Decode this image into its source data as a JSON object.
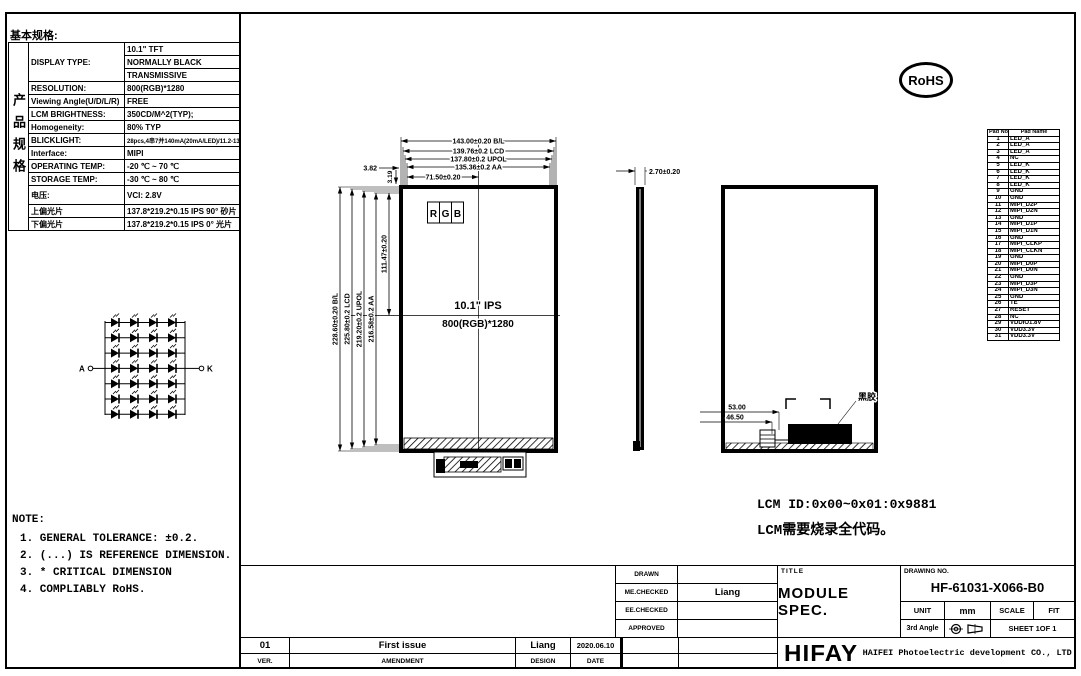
{
  "header": {
    "basic_spec_label": "基本规格:",
    "rohs_label": "RoHS"
  },
  "spec_table": {
    "side_label": "产品规格",
    "rows": [
      {
        "label": "DISPLAY TYPE:",
        "value": "10.1\" TFT",
        "label_rowspan": 3
      },
      {
        "label": null,
        "value": "NORMALLY BLACK"
      },
      {
        "label": null,
        "value": "TRANSMISSIVE"
      },
      {
        "label": "RESOLUTION:",
        "value": "800(RGB)*1280"
      },
      {
        "label": "Viewing Angle(U/D/L/R)",
        "value": "FREE"
      },
      {
        "label": "LCM BRIGHTNESS:",
        "value": "350CD/M^2(TYP);"
      },
      {
        "label": "Homogeneity:",
        "value": "80% TYP"
      },
      {
        "label": "BLICKLIGHT:",
        "value": "28pcs,4串7并140mA(20mA/LED)/11.2-13.2V",
        "small": true
      },
      {
        "label": "Interface:",
        "value": "MIPI"
      },
      {
        "label": "OPERATING TEMP:",
        "value": "-20 ℃ ~ 70 ℃"
      },
      {
        "label": "STORAGE TEMP:",
        "value": "-30 ℃ ~ 80 ℃"
      },
      {
        "label": "电压:",
        "value": "VCI: 2.8V",
        "tall": true
      },
      {
        "label": "上偏光片",
        "value": "137.8*219.2*0.15 IPS 90° 砂片"
      },
      {
        "label": "下偏光片",
        "value": "137.8*219.2*0.15 IPS 0° 光片"
      }
    ]
  },
  "led_diagram": {
    "rows": 7,
    "cols": 4,
    "anode_label": "A",
    "cathode_label": "K"
  },
  "front_view": {
    "rgb_letters": [
      "R",
      "G",
      "B"
    ],
    "size_label": "10.1\" IPS",
    "resolution_label": "800(RGB)*1280"
  },
  "dims": {
    "bl_w": "143.00±0.20 B/L",
    "lcd_w": "139.76±0.2 LCD",
    "upol_w": "137.80±0.2 UPOL",
    "aa_w": "135.36±0.2 AA",
    "half_w": "71.50±0.20",
    "off_382": "3.82",
    "off_319": "3.19",
    "bl_h": "228.60±0.20 B/L",
    "lcd_h": "225.80±0.2 LCD",
    "upol_h": "219.20±0.2 UPOL",
    "aa_h": "216.58±0.2 AA",
    "half_h": "111.47±0.20",
    "thickness": "2.70±0.20",
    "conn_a": "53.00",
    "conn_b": "46.50",
    "glue_label": "黑胶"
  },
  "notes": {
    "title": "NOTE:",
    "items": [
      "1. GENERAL TOLERANCE: ±0.2.",
      "2. (...) IS REFERENCE DIMENSION.",
      "3. * CRITICAL DIMENSION",
      "4. COMPLIABLY RoHS."
    ]
  },
  "lcm": {
    "line1": "LCM ID:0x00~0x01:0x9881",
    "line2": "LCM需要烧录全代码。"
  },
  "pad_table": {
    "headers": [
      "Pad No.",
      "Pad Name"
    ],
    "rows": [
      {
        "no": "1",
        "name": "LED_A"
      },
      {
        "no": "2",
        "name": "LED_A"
      },
      {
        "no": "3",
        "name": "LED_A"
      },
      {
        "no": "4",
        "name": "NC"
      },
      {
        "no": "5",
        "name": "LED_K"
      },
      {
        "no": "6",
        "name": "LED_K"
      },
      {
        "no": "7",
        "name": "LED_K"
      },
      {
        "no": "8",
        "name": "LED_K"
      },
      {
        "no": "9",
        "name": "GND"
      },
      {
        "no": "10",
        "name": "GND"
      },
      {
        "no": "11",
        "name": "MIPI_D2P"
      },
      {
        "no": "12",
        "name": "MIPI_D2N"
      },
      {
        "no": "13",
        "name": "GND"
      },
      {
        "no": "14",
        "name": "MIPI_D1P"
      },
      {
        "no": "15",
        "name": "MIPI_D1N"
      },
      {
        "no": "16",
        "name": "GND"
      },
      {
        "no": "17",
        "name": "MIPI_CLKP"
      },
      {
        "no": "18",
        "name": "MIPI_CLKN"
      },
      {
        "no": "19",
        "name": "GND"
      },
      {
        "no": "20",
        "name": "MIPI_D0P"
      },
      {
        "no": "21",
        "name": "MIPI_D0N"
      },
      {
        "no": "22",
        "name": "GND"
      },
      {
        "no": "23",
        "name": "MIPI_D3P"
      },
      {
        "no": "24",
        "name": "MIPI_D3N"
      },
      {
        "no": "25",
        "name": "GND"
      },
      {
        "no": "26",
        "name": "TE"
      },
      {
        "no": "27",
        "name": "RESET"
      },
      {
        "no": "28",
        "name": "NC"
      },
      {
        "no": "29",
        "name": "VDDIO1.8V"
      },
      {
        "no": "30",
        "name": "VDD3.3V"
      },
      {
        "no": "31",
        "name": "VDD3.3V"
      }
    ]
  },
  "title_block": {
    "drawn_label": "DRAWN",
    "drawn_value": "",
    "me_checked_label": "ME.CHECKED",
    "me_checked_value": "Liang",
    "ee_checked_label": "EE.CHECKED",
    "ee_checked_value": "",
    "approved_label": "APPROVED",
    "approved_value": "",
    "title_label": "TITLE",
    "title_value": "MODULE SPEC.",
    "drawing_no_label": "DRAWING NO.",
    "drawing_no_value": "HF-61031-X066-B0",
    "unit_label": "UNIT",
    "unit_value": "mm",
    "scale_label": "SCALE",
    "scale_value": "FIT",
    "angle_label": "3rd Angle",
    "sheet_label": "SHEET 1OF 1",
    "logo_text": "HIFAY",
    "company_name": "HAIFEI Photoelectric development CO., LTD"
  },
  "revision": {
    "ver_value": "01",
    "amendment_value": "First issue",
    "design_value": "Liang",
    "date_value": "2020.06.10",
    "ver_label": "VER.",
    "amendment_label": "AMENDMENT",
    "design_label": "DESIGN",
    "date_label": "DATE"
  }
}
